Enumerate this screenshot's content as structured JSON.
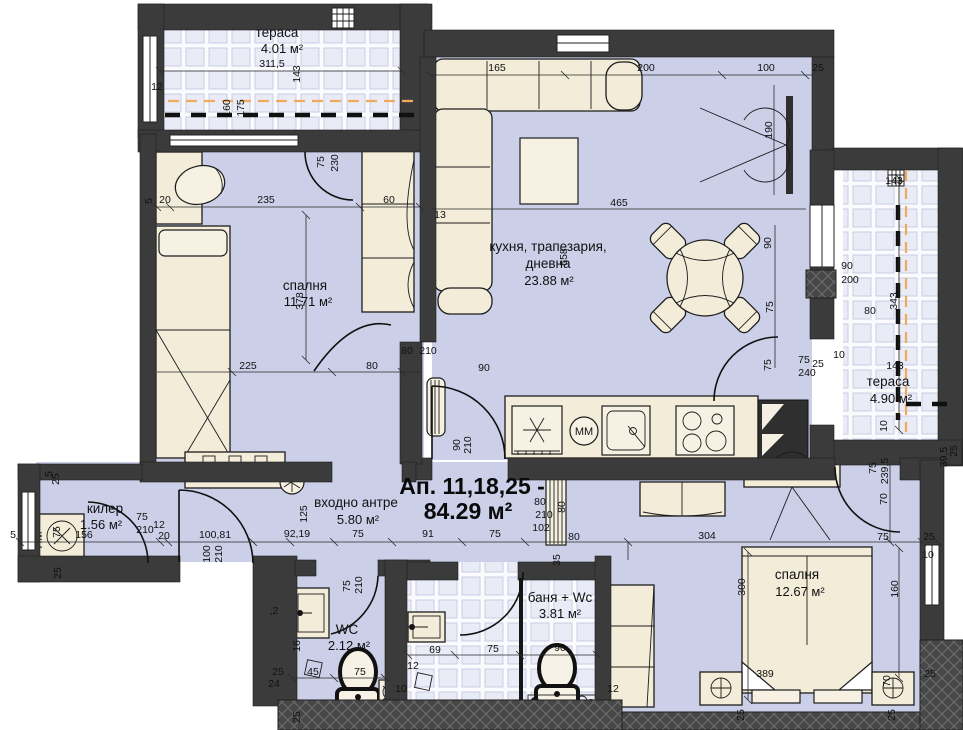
{
  "title": {
    "apartment": "Ап. 11,18,25 -",
    "total_area": "84.29 м²"
  },
  "rooms": {
    "terrace1": {
      "name": "тераса",
      "area": "4.01 м²"
    },
    "bedroom1": {
      "name": "спалня",
      "area": "11.71 м²"
    },
    "living": {
      "name_line1": "кухня, трапезария,",
      "name_line2": "дневна",
      "area": "23.88 м²"
    },
    "terrace2": {
      "name": "тераса",
      "area": "4.90 м²"
    },
    "closet": {
      "name": "килер",
      "area": "1.56 м²"
    },
    "hall": {
      "name": "входно антре",
      "area": "5.80 м²"
    },
    "wc": {
      "name": "WC",
      "area": "2.12 м²"
    },
    "bath": {
      "name": "баня + Wc",
      "area": "3.81 м²"
    },
    "bedroom2": {
      "name": "спалня",
      "area": "12.67 м²"
    }
  },
  "appliances": {
    "washing_machine": "ПМ",
    "microwave": "MM"
  },
  "colors": {
    "wall": "#3b3b3b",
    "floor": "#cbd0e8",
    "furniture": "#f2ecd9",
    "pipe": "#f0aa5e"
  },
  "dim_labels": [
    {
      "t": "311,5",
      "x": 272,
      "y": 67
    },
    {
      "t": "143",
      "x": 300,
      "y": 74,
      "r": -90
    },
    {
      "t": "12",
      "x": 157,
      "y": 90
    },
    {
      "t": "160",
      "x": 230,
      "y": 108,
      "r": -90
    },
    {
      "t": "175",
      "x": 244,
      "y": 108,
      "r": -90
    },
    {
      "t": "165",
      "x": 497,
      "y": 71
    },
    {
      "t": "200",
      "x": 646,
      "y": 71
    },
    {
      "t": "100",
      "x": 766,
      "y": 71
    },
    {
      "t": "25",
      "x": 818,
      "y": 71
    },
    {
      "t": "13",
      "x": 440,
      "y": 218
    },
    {
      "t": "465",
      "x": 619,
      "y": 206
    },
    {
      "t": "190",
      "x": 772,
      "y": 130,
      "r": -90
    },
    {
      "t": "235",
      "x": 266,
      "y": 203
    },
    {
      "t": "5",
      "x": 152,
      "y": 201,
      "r": -90
    },
    {
      "t": "20",
      "x": 165,
      "y": 203
    },
    {
      "t": "60",
      "x": 389,
      "y": 203
    },
    {
      "t": "75",
      "x": 324,
      "y": 162,
      "r": -90
    },
    {
      "t": "230",
      "x": 338,
      "y": 163,
      "r": -90
    },
    {
      "t": "378",
      "x": 303,
      "y": 301,
      "r": -90
    },
    {
      "t": "558",
      "x": 567,
      "y": 257,
      "r": -90
    },
    {
      "t": "225",
      "x": 248,
      "y": 369
    },
    {
      "t": "80",
      "x": 372,
      "y": 369
    },
    {
      "t": "90",
      "x": 771,
      "y": 243,
      "r": -90
    },
    {
      "t": "75",
      "x": 773,
      "y": 307,
      "r": -90
    },
    {
      "t": "75",
      "x": 771,
      "y": 365,
      "r": -90
    },
    {
      "t": "80",
      "x": 407,
      "y": 354
    },
    {
      "t": "210",
      "x": 428,
      "y": 354
    },
    {
      "t": "90",
      "x": 484,
      "y": 371
    },
    {
      "t": "90",
      "x": 460,
      "y": 445,
      "r": -90
    },
    {
      "t": "210",
      "x": 471,
      "y": 445,
      "r": -90
    },
    {
      "t": "75",
      "x": 804,
      "y": 363
    },
    {
      "t": "240",
      "x": 807,
      "y": 376
    },
    {
      "t": "25",
      "x": 818,
      "y": 367
    },
    {
      "t": "10",
      "x": 839,
      "y": 358
    },
    {
      "t": "143",
      "x": 894,
      "y": 184
    },
    {
      "t": "90",
      "x": 847,
      "y": 269
    },
    {
      "t": "200",
      "x": 850,
      "y": 283
    },
    {
      "t": "80",
      "x": 870,
      "y": 314
    },
    {
      "t": "343",
      "x": 897,
      "y": 301,
      "r": -90
    },
    {
      "t": "143",
      "x": 895,
      "y": 369
    },
    {
      "t": "10",
      "x": 887,
      "y": 426,
      "r": -90
    },
    {
      "t": "39,5",
      "x": 947,
      "y": 457,
      "r": -90
    },
    {
      "t": "25",
      "x": 957,
      "y": 451,
      "r": -90
    },
    {
      "t": "75",
      "x": 876,
      "y": 468,
      "r": -90
    },
    {
      "t": "239,5",
      "x": 888,
      "y": 471,
      "r": -90
    },
    {
      "t": "70",
      "x": 887,
      "y": 499,
      "r": -90
    },
    {
      "t": "75",
      "x": 883,
      "y": 540
    },
    {
      "t": "25",
      "x": 929,
      "y": 540
    },
    {
      "t": "10",
      "x": 928,
      "y": 558
    },
    {
      "t": "160",
      "x": 898,
      "y": 589,
      "r": -90
    },
    {
      "t": "300",
      "x": 745,
      "y": 587,
      "r": -90
    },
    {
      "t": "389",
      "x": 765,
      "y": 677
    },
    {
      "t": "70",
      "x": 890,
      "y": 681,
      "r": -90
    },
    {
      "t": "25",
      "x": 930,
      "y": 677
    },
    {
      "t": "25",
      "x": 744,
      "y": 715,
      "r": -90
    },
    {
      "t": "25",
      "x": 895,
      "y": 715,
      "r": -90
    },
    {
      "t": "12",
      "x": 613,
      "y": 692
    },
    {
      "t": "100,81",
      "x": 215,
      "y": 538
    },
    {
      "t": "92,19",
      "x": 297,
      "y": 537
    },
    {
      "t": "75",
      "x": 358,
      "y": 537
    },
    {
      "t": "91",
      "x": 428,
      "y": 537
    },
    {
      "t": "75",
      "x": 495,
      "y": 537
    },
    {
      "t": "80",
      "x": 574,
      "y": 540
    },
    {
      "t": "304",
      "x": 707,
      "y": 539
    },
    {
      "t": "35",
      "x": 560,
      "y": 560,
      "r": -90
    },
    {
      "t": "80",
      "x": 540,
      "y": 505
    },
    {
      "t": "210",
      "x": 544,
      "y": 518
    },
    {
      "t": "102",
      "x": 541,
      "y": 531
    },
    {
      "t": "80",
      "x": 565,
      "y": 507,
      "r": -90
    },
    {
      "t": "125",
      "x": 307,
      "y": 514,
      "r": -90
    },
    {
      "t": "156",
      "x": 84,
      "y": 538
    },
    {
      "t": "75",
      "x": 142,
      "y": 520
    },
    {
      "t": "210",
      "x": 145,
      "y": 533
    },
    {
      "t": "12",
      "x": 159,
      "y": 528
    },
    {
      "t": "20",
      "x": 164,
      "y": 539
    },
    {
      "t": "75",
      "x": 60,
      "y": 532,
      "r": -90
    },
    {
      "t": "100",
      "x": 210,
      "y": 554,
      "r": -90
    },
    {
      "t": "210",
      "x": 222,
      "y": 554,
      "r": -90
    },
    {
      "t": "5",
      "x": 52,
      "y": 474,
      "r": -90
    },
    {
      "t": "25",
      "x": 59,
      "y": 479,
      "r": -90
    },
    {
      "t": "5",
      "x": 13,
      "y": 538
    },
    {
      "t": "25",
      "x": 61,
      "y": 573,
      "r": -90
    },
    {
      "t": "75",
      "x": 350,
      "y": 586,
      "r": -90
    },
    {
      "t": "210",
      "x": 362,
      "y": 585,
      "r": -90
    },
    {
      "t": "16",
      "x": 300,
      "y": 646,
      "r": -90
    },
    {
      "t": "45",
      "x": 313,
      "y": 675
    },
    {
      "t": "75",
      "x": 360,
      "y": 675
    },
    {
      "t": "25",
      "x": 278,
      "y": 675
    },
    {
      "t": "24",
      "x": 274,
      "y": 687
    },
    {
      "t": "25",
      "x": 300,
      "y": 717,
      "r": -90
    },
    {
      "t": ",2",
      "x": 274,
      "y": 614
    },
    {
      "t": "12",
      "x": 413,
      "y": 669
    },
    {
      "t": "69",
      "x": 435,
      "y": 653
    },
    {
      "t": "75",
      "x": 493,
      "y": 652
    },
    {
      "t": "90",
      "x": 560,
      "y": 651
    },
    {
      "t": "10",
      "x": 401,
      "y": 692
    }
  ]
}
